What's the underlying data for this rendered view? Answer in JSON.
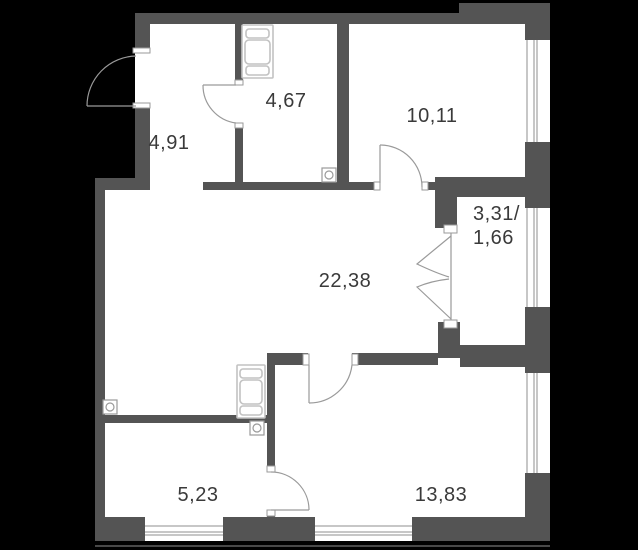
{
  "colors": {
    "background": "#000000",
    "wall": "#545454",
    "floor": "#ffffff",
    "door_line": "#9a9a9a",
    "fixture_line": "#c2c2c2",
    "label_text": "#3a3a3a"
  },
  "rooms": {
    "hallway": {
      "area": "4,91"
    },
    "bathroom": {
      "area": "4,67"
    },
    "bedroom": {
      "area": "10,11"
    },
    "balcony": {
      "area_line1": "3,31/",
      "area_line2": "1,66"
    },
    "living": {
      "area": "22,38"
    },
    "kitchen": {
      "area": "5,23"
    },
    "room": {
      "area": "13,83"
    }
  }
}
